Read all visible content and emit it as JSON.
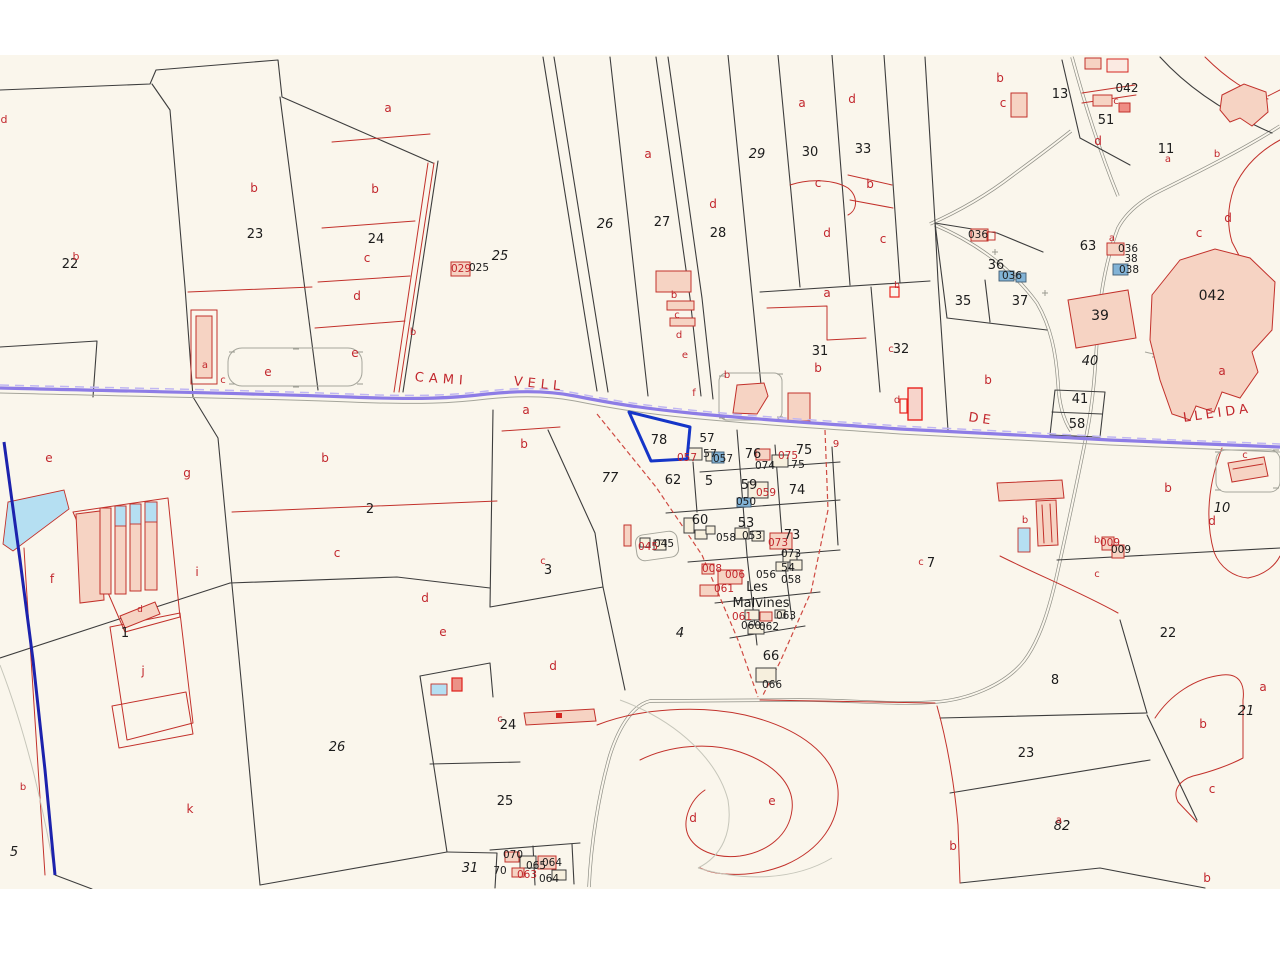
{
  "map": {
    "type": "cadastral-parcel-map",
    "selected_parcel": {
      "id": "78",
      "outline_color": "#1535c8"
    },
    "colors": {
      "background": "#faf6ec",
      "parcel_line": "#3d3d3d",
      "subparcel_line": "#c2312b",
      "road_purple": "#8d7ce6",
      "highlight_blue": "#1535c8",
      "water_blue": "#b5dff2",
      "building_pink": "#f6d3c3",
      "building_blue": "#82b3d6",
      "label_black": "#1c1c1c",
      "label_red": "#c2272d"
    },
    "labels": {
      "road_names": [
        {
          "t": "CAMI",
          "x": 441,
          "y": 383,
          "r": 4,
          "ls": 5
        },
        {
          "t": "VELL",
          "x": 539,
          "y": 388,
          "r": 6,
          "ls": 5
        },
        {
          "t": "DE",
          "x": 981,
          "y": 423,
          "r": 8,
          "ls": 4
        },
        {
          "t": "LLEIDA",
          "x": 1218,
          "y": 417,
          "r": -8,
          "ls": 4
        }
      ],
      "place_names": [
        {
          "t": "Les",
          "x": 757,
          "y": 591
        },
        {
          "t": "Malvines",
          "x": 761,
          "y": 607
        }
      ],
      "parcel_numbers": [
        {
          "t": "22",
          "x": 70,
          "y": 268
        },
        {
          "t": "23",
          "x": 255,
          "y": 238
        },
        {
          "t": "24",
          "x": 376,
          "y": 243
        },
        {
          "t": "25",
          "x": 500,
          "y": 260,
          "i": 1
        },
        {
          "t": "26",
          "x": 605,
          "y": 228,
          "i": 1
        },
        {
          "t": "27",
          "x": 662,
          "y": 226
        },
        {
          "t": "28",
          "x": 718,
          "y": 237
        },
        {
          "t": "29",
          "x": 757,
          "y": 158,
          "i": 1
        },
        {
          "t": "30",
          "x": 810,
          "y": 156
        },
        {
          "t": "33",
          "x": 863,
          "y": 153
        },
        {
          "t": "31",
          "x": 820,
          "y": 355
        },
        {
          "t": "32",
          "x": 901,
          "y": 353
        },
        {
          "t": "13",
          "x": 1060,
          "y": 98
        },
        {
          "t": "51",
          "x": 1106,
          "y": 124
        },
        {
          "t": "11",
          "x": 1166,
          "y": 153
        },
        {
          "t": "36",
          "x": 996,
          "y": 269
        },
        {
          "t": "35",
          "x": 963,
          "y": 305
        },
        {
          "t": "37",
          "x": 1020,
          "y": 305
        },
        {
          "t": "39",
          "x": 1100,
          "y": 320,
          "s": 14
        },
        {
          "t": "40",
          "x": 1090,
          "y": 365,
          "i": 1
        },
        {
          "t": "41",
          "x": 1080,
          "y": 403
        },
        {
          "t": "58",
          "x": 1077,
          "y": 428
        },
        {
          "t": "63",
          "x": 1088,
          "y": 250
        },
        {
          "t": "042",
          "x": 1212,
          "y": 300,
          "s": 14
        },
        {
          "t": "042",
          "x": 1127,
          "y": 92,
          "s": 12
        },
        {
          "t": "10",
          "x": 1222,
          "y": 512,
          "i": 1
        },
        {
          "t": "22",
          "x": 1168,
          "y": 637
        },
        {
          "t": "8",
          "x": 1055,
          "y": 684
        },
        {
          "t": "21",
          "x": 1246,
          "y": 715,
          "i": 1
        },
        {
          "t": "23",
          "x": 1026,
          "y": 757
        },
        {
          "t": "82",
          "x": 1062,
          "y": 830,
          "i": 1
        },
        {
          "t": "7",
          "x": 931,
          "y": 567
        },
        {
          "t": "2",
          "x": 370,
          "y": 513
        },
        {
          "t": "3",
          "x": 548,
          "y": 574
        },
        {
          "t": "77",
          "x": 610,
          "y": 482,
          "i": 1
        },
        {
          "t": "1",
          "x": 125,
          "y": 637
        },
        {
          "t": "4",
          "x": 680,
          "y": 637,
          "i": 1
        },
        {
          "t": "5",
          "x": 14,
          "y": 856,
          "i": 1
        },
        {
          "t": "26",
          "x": 337,
          "y": 751,
          "i": 1
        },
        {
          "t": "24",
          "x": 508,
          "y": 729
        },
        {
          "t": "25",
          "x": 505,
          "y": 805
        },
        {
          "t": "31",
          "x": 470,
          "y": 872,
          "i": 1
        },
        {
          "t": "66",
          "x": 771,
          "y": 660
        },
        {
          "t": "78",
          "x": 659,
          "y": 444
        },
        {
          "t": "57",
          "x": 707,
          "y": 442,
          "s": 12
        },
        {
          "t": "57",
          "x": 710,
          "y": 457,
          "s": 11
        },
        {
          "t": "62",
          "x": 673,
          "y": 484
        },
        {
          "t": "5",
          "x": 709,
          "y": 485
        },
        {
          "t": "59",
          "x": 749,
          "y": 489
        },
        {
          "t": "74",
          "x": 797,
          "y": 494
        },
        {
          "t": "76",
          "x": 753,
          "y": 458
        },
        {
          "t": "75",
          "x": 804,
          "y": 454
        },
        {
          "t": "75",
          "x": 798,
          "y": 468,
          "s": 11
        },
        {
          "t": "60",
          "x": 700,
          "y": 524
        },
        {
          "t": "53",
          "x": 746,
          "y": 527
        },
        {
          "t": "73",
          "x": 792,
          "y": 539
        },
        {
          "t": "54",
          "x": 788,
          "y": 571,
          "s": 11
        }
      ],
      "building_codes_black": [
        {
          "t": "025",
          "x": 479,
          "y": 271
        },
        {
          "t": "036",
          "x": 978,
          "y": 238
        },
        {
          "t": "036",
          "x": 1012,
          "y": 279
        },
        {
          "t": "036",
          "x": 1128,
          "y": 252
        },
        {
          "t": "38",
          "x": 1131,
          "y": 262
        },
        {
          "t": "038",
          "x": 1129,
          "y": 273
        },
        {
          "t": "057",
          "x": 723,
          "y": 462
        },
        {
          "t": "050",
          "x": 746,
          "y": 505
        },
        {
          "t": "074",
          "x": 765,
          "y": 469
        },
        {
          "t": "053",
          "x": 752,
          "y": 539
        },
        {
          "t": "058",
          "x": 726,
          "y": 541
        },
        {
          "t": "073",
          "x": 791,
          "y": 557
        },
        {
          "t": "056",
          "x": 766,
          "y": 578
        },
        {
          "t": "058",
          "x": 791,
          "y": 583
        },
        {
          "t": "063",
          "x": 786,
          "y": 619
        },
        {
          "t": "060",
          "x": 751,
          "y": 629
        },
        {
          "t": "062",
          "x": 769,
          "y": 630
        },
        {
          "t": "066",
          "x": 772,
          "y": 688
        },
        {
          "t": "070",
          "x": 513,
          "y": 858
        },
        {
          "t": "065",
          "x": 536,
          "y": 869
        },
        {
          "t": "064",
          "x": 552,
          "y": 866
        },
        {
          "t": "70",
          "x": 500,
          "y": 874
        },
        {
          "t": "064",
          "x": 549,
          "y": 882
        },
        {
          "t": "045",
          "x": 664,
          "y": 547
        },
        {
          "t": "009",
          "x": 1121,
          "y": 553
        }
      ],
      "building_codes_red": [
        {
          "t": "029",
          "x": 461,
          "y": 272
        },
        {
          "t": "057",
          "x": 687,
          "y": 461
        },
        {
          "t": "059",
          "x": 766,
          "y": 496
        },
        {
          "t": "075",
          "x": 788,
          "y": 459
        },
        {
          "t": "073",
          "x": 778,
          "y": 546
        },
        {
          "t": "008",
          "x": 712,
          "y": 572
        },
        {
          "t": "006",
          "x": 735,
          "y": 578
        },
        {
          "t": "061",
          "x": 724,
          "y": 592
        },
        {
          "t": "061",
          "x": 742,
          "y": 620
        },
        {
          "t": "063",
          "x": 527,
          "y": 878
        },
        {
          "t": "045",
          "x": 648,
          "y": 550
        },
        {
          "t": "009",
          "x": 1110,
          "y": 546
        }
      ],
      "subparcel_letters": [
        {
          "t": "d",
          "x": 4,
          "y": 123,
          "s": 11
        },
        {
          "t": "b",
          "x": 76,
          "y": 260,
          "s": 11
        },
        {
          "t": "b",
          "x": 254,
          "y": 192
        },
        {
          "t": "a",
          "x": 388,
          "y": 112
        },
        {
          "t": "b",
          "x": 375,
          "y": 193
        },
        {
          "t": "c",
          "x": 367,
          "y": 262
        },
        {
          "t": "d",
          "x": 357,
          "y": 300
        },
        {
          "t": "e",
          "x": 355,
          "y": 357
        },
        {
          "t": "b",
          "x": 413,
          "y": 335,
          "s": 10
        },
        {
          "t": "a",
          "x": 205,
          "y": 368,
          "s": 10
        },
        {
          "t": "c",
          "x": 223,
          "y": 383,
          "s": 10
        },
        {
          "t": "e",
          "x": 268,
          "y": 376
        },
        {
          "t": "a",
          "x": 648,
          "y": 158
        },
        {
          "t": "d",
          "x": 713,
          "y": 208
        },
        {
          "t": "b",
          "x": 674,
          "y": 298,
          "s": 10
        },
        {
          "t": "c",
          "x": 677,
          "y": 318,
          "s": 10
        },
        {
          "t": "d",
          "x": 679,
          "y": 338,
          "s": 10
        },
        {
          "t": "e",
          "x": 685,
          "y": 358,
          "s": 10
        },
        {
          "t": "f",
          "x": 694,
          "y": 396,
          "s": 10
        },
        {
          "t": "a",
          "x": 802,
          "y": 107
        },
        {
          "t": "d",
          "x": 852,
          "y": 103
        },
        {
          "t": "c",
          "x": 818,
          "y": 187
        },
        {
          "t": "b",
          "x": 870,
          "y": 188
        },
        {
          "t": "d",
          "x": 827,
          "y": 237
        },
        {
          "t": "c",
          "x": 883,
          "y": 243
        },
        {
          "t": "a",
          "x": 827,
          "y": 297
        },
        {
          "t": "b",
          "x": 818,
          "y": 372
        },
        {
          "t": "c",
          "x": 891,
          "y": 352,
          "s": 10
        },
        {
          "t": "d",
          "x": 897,
          "y": 403,
          "s": 10
        },
        {
          "t": "9",
          "x": 836,
          "y": 447,
          "s": 10
        },
        {
          "t": "b",
          "x": 727,
          "y": 378,
          "s": 10
        },
        {
          "t": "b",
          "x": 1000,
          "y": 82
        },
        {
          "t": "c",
          "x": 1003,
          "y": 107
        },
        {
          "t": "c",
          "x": 1116,
          "y": 104,
          "s": 10
        },
        {
          "t": "d",
          "x": 1098,
          "y": 145
        },
        {
          "t": "a",
          "x": 1168,
          "y": 162,
          "s": 10
        },
        {
          "t": "a",
          "x": 1112,
          "y": 241,
          "s": 10
        },
        {
          "t": "b",
          "x": 1217,
          "y": 157,
          "s": 10
        },
        {
          "t": "d",
          "x": 1228,
          "y": 222
        },
        {
          "t": "c",
          "x": 1199,
          "y": 237
        },
        {
          "t": "a",
          "x": 1222,
          "y": 375
        },
        {
          "t": "b",
          "x": 988,
          "y": 384
        },
        {
          "t": "e",
          "x": 49,
          "y": 462
        },
        {
          "t": "g",
          "x": 187,
          "y": 477
        },
        {
          "t": "f",
          "x": 52,
          "y": 583
        },
        {
          "t": "i",
          "x": 197,
          "y": 576
        },
        {
          "t": "j",
          "x": 143,
          "y": 675
        },
        {
          "t": "k",
          "x": 190,
          "y": 813
        },
        {
          "t": "b",
          "x": 23,
          "y": 790,
          "s": 10
        },
        {
          "t": "b",
          "x": 325,
          "y": 462
        },
        {
          "t": "c",
          "x": 337,
          "y": 557
        },
        {
          "t": "a",
          "x": 526,
          "y": 414
        },
        {
          "t": "b",
          "x": 524,
          "y": 448
        },
        {
          "t": "c",
          "x": 543,
          "y": 564,
          "s": 10
        },
        {
          "t": "d",
          "x": 553,
          "y": 670
        },
        {
          "t": "e",
          "x": 443,
          "y": 636
        },
        {
          "t": "d",
          "x": 425,
          "y": 602
        },
        {
          "t": "c",
          "x": 500,
          "y": 722,
          "s": 10
        },
        {
          "t": "d",
          "x": 693,
          "y": 822
        },
        {
          "t": "e",
          "x": 772,
          "y": 805
        },
        {
          "t": "c",
          "x": 921,
          "y": 565,
          "s": 10
        },
        {
          "t": "b",
          "x": 1025,
          "y": 523,
          "s": 10
        },
        {
          "t": "b",
          "x": 1097,
          "y": 543,
          "s": 10
        },
        {
          "t": "c",
          "x": 1097,
          "y": 577,
          "s": 10
        },
        {
          "t": "d",
          "x": 1212,
          "y": 525
        },
        {
          "t": "b",
          "x": 1168,
          "y": 492
        },
        {
          "t": "c",
          "x": 1245,
          "y": 458,
          "s": 10
        },
        {
          "t": "a",
          "x": 1263,
          "y": 691
        },
        {
          "t": "b",
          "x": 1203,
          "y": 728
        },
        {
          "t": "c",
          "x": 1212,
          "y": 793
        },
        {
          "t": "b",
          "x": 953,
          "y": 850
        },
        {
          "t": "b",
          "x": 1207,
          "y": 882
        },
        {
          "t": "a",
          "x": 1059,
          "y": 823,
          "s": 10
        },
        {
          "t": "d",
          "x": 140,
          "y": 612,
          "s": 9
        },
        {
          "t": "b",
          "x": 897,
          "y": 288,
          "s": 9
        }
      ]
    }
  }
}
